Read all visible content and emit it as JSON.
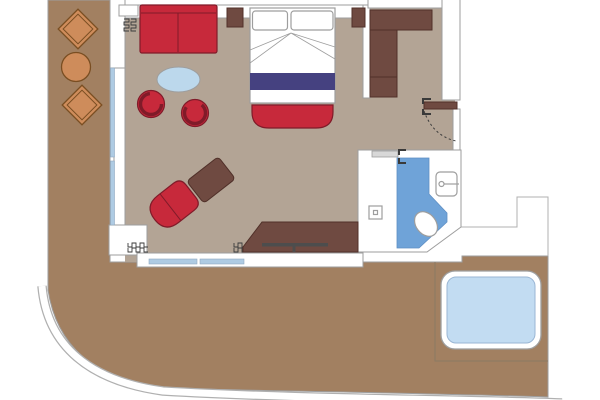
{
  "plan": {
    "kind": "suite-floor-plan",
    "rooms": [
      {
        "name": "living-bedroom",
        "floor_color_key": "interior_floor"
      },
      {
        "name": "entry-hall",
        "floor_color_key": "interior_floor"
      },
      {
        "name": "wardrobe-nook",
        "floor_color_key": "interior_floor"
      },
      {
        "name": "bathroom",
        "floor_color_key": "bathroom_floor_blue"
      },
      {
        "name": "balcony-deck",
        "floor_color_key": "balcony"
      }
    ],
    "furniture": [
      {
        "name": "sofa",
        "color_key": "red_upholstery"
      },
      {
        "name": "coffee-table-oval",
        "color_key": "coffee_table_blue"
      },
      {
        "name": "tub-chair-1",
        "color_key": "red_upholstery"
      },
      {
        "name": "tub-chair-2",
        "color_key": "red_upholstery"
      },
      {
        "name": "chaise-lounge",
        "color_key": "red_upholstery"
      },
      {
        "name": "ottoman",
        "color_key": "dark_wood"
      },
      {
        "name": "nightstand-left",
        "color_key": "dark_wood"
      },
      {
        "name": "nightstand-right",
        "color_key": "dark_wood"
      },
      {
        "name": "double-bed",
        "color_key": "bed_linen"
      },
      {
        "name": "bed-pillow-left",
        "color_key": "bed_linen"
      },
      {
        "name": "bed-pillow-right",
        "color_key": "bed_linen"
      },
      {
        "name": "bed-runner",
        "color_key": "bed_runner_navy"
      },
      {
        "name": "foot-bench",
        "color_key": "red_upholstery"
      },
      {
        "name": "wardrobe-l-shaped",
        "color_key": "dark_wood"
      },
      {
        "name": "desk-console",
        "color_key": "dark_wood"
      },
      {
        "name": "entrance-door",
        "color_key": "dark_wood"
      },
      {
        "name": "bathroom-sliding-door",
        "color_key": "sliding_door_gray"
      },
      {
        "name": "shower-drain",
        "color_key": "wall_fill"
      },
      {
        "name": "washbasin",
        "color_key": "wall_fill"
      },
      {
        "name": "toilet",
        "color_key": "wall_fill"
      },
      {
        "name": "deck-chair-top",
        "color_key": "deck_wood_furniture"
      },
      {
        "name": "deck-table-round",
        "color_key": "deck_wood_furniture"
      },
      {
        "name": "deck-chair-bottom",
        "color_key": "deck_wood_furniture"
      },
      {
        "name": "whirlpool-hot-tub",
        "color_key": "whirlpool_water"
      }
    ],
    "symbols": [
      {
        "name": "door-swing-arc"
      },
      {
        "name": "door-hinge-marks"
      },
      {
        "name": "curtain-squiggles"
      },
      {
        "name": "window-glazing-lines"
      },
      {
        "name": "ship-hull-band"
      }
    ]
  },
  "colors": {
    "page_bg": "#ffffff",
    "balcony": "#a28061",
    "deck_wood_furniture": "#ce8c5b",
    "deck_furniture_outline": "#7a4e22",
    "deck_divider_line": "#8b7a64",
    "interior_floor": "#b3a495",
    "wall_fill": "#ffffff",
    "wall_outline": "#9e9e9e",
    "hull_band_edge": "#b0b0b0",
    "red_upholstery": "#c7293b",
    "red_outline": "#801b29",
    "dark_wood": "#6f4a41",
    "dark_wood_outline": "#503029",
    "bed_linen": "#ffffff",
    "bed_runner_navy": "#454180",
    "coffee_table_blue": "#bcd8ec",
    "window_glass": "#aecbe3",
    "window_glass_edge": "#8fa9c0",
    "bathroom_floor_blue": "#6fa3d8",
    "bathroom_floor_edge": "#5f8fc4",
    "whirlpool_water": "#c2dcf2",
    "whirlpool_water_edge": "#9ab6d4",
    "whirlpool_rim": "#ffffff",
    "sliding_door_gray": "#d8d8d8",
    "door_symbol_dark": "#3a3a3a",
    "desk_accent_gray": "#4d4d4d"
  }
}
